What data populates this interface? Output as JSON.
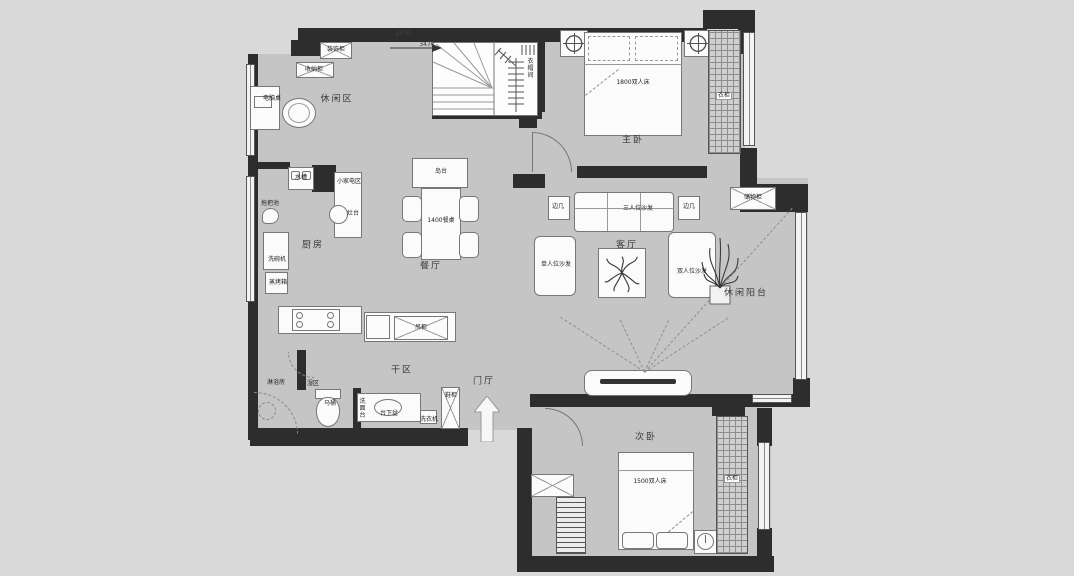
{
  "title": "apartment-floor-plan",
  "colors": {
    "background": "#d9d9d9",
    "floor": "#c5c5c5",
    "wall": "#2d2d2d",
    "furniture": "#fbfbfb",
    "line": "#777777"
  },
  "rooms": [
    "休闲区",
    "主卧",
    "客厅",
    "餐厅",
    "厨房",
    "干区",
    "湿区",
    "门厅",
    "休闲阳台",
    "次卧"
  ],
  "labels": [
    {
      "id": "leisure-area",
      "cls": "room",
      "text": "休闲区",
      "x": 337,
      "y": 100
    },
    {
      "id": "master-bedroom",
      "cls": "room",
      "text": "主卧",
      "x": 633,
      "y": 141
    },
    {
      "id": "living-room",
      "cls": "room",
      "text": "客厅",
      "x": 627,
      "y": 246
    },
    {
      "id": "dining-room",
      "cls": "room",
      "text": "餐厅",
      "x": 431,
      "y": 267
    },
    {
      "id": "kitchen",
      "cls": "room",
      "text": "厨房",
      "x": 313,
      "y": 246
    },
    {
      "id": "dry-area",
      "cls": "room",
      "text": "干区",
      "x": 402,
      "y": 371
    },
    {
      "id": "wet-area",
      "cls": "item",
      "text": "湿区",
      "x": 313,
      "y": 384
    },
    {
      "id": "shower-room",
      "cls": "item",
      "text": "淋浴房",
      "x": 276,
      "y": 383
    },
    {
      "id": "foyer",
      "cls": "room",
      "text": "门厅",
      "x": 484,
      "y": 382
    },
    {
      "id": "leisure-balcony",
      "cls": "room",
      "text": "休闲阳台",
      "x": 746,
      "y": 294
    },
    {
      "id": "second-bedroom",
      "cls": "room",
      "text": "次卧",
      "x": 646,
      "y": 438
    },
    {
      "id": "decor-cabinet",
      "cls": "item",
      "text": "装饰柜",
      "x": 336,
      "y": 50
    },
    {
      "id": "storage-low-cabinet",
      "cls": "item",
      "text": "收纳柜",
      "x": 314,
      "y": 70
    },
    {
      "id": "computer-desk",
      "cls": "item",
      "text": "电脑桌",
      "x": 272,
      "y": 99
    },
    {
      "id": "cloakroom",
      "cls": "vert",
      "text": "衣帽间",
      "x": 529,
      "y": 68
    },
    {
      "id": "master-bed",
      "cls": "item",
      "text": "1800双人床",
      "x": 633,
      "y": 83
    },
    {
      "id": "sofa-three-seat",
      "cls": "item",
      "text": "三人位沙发",
      "x": 638,
      "y": 209
    },
    {
      "id": "side-table-left",
      "cls": "item",
      "text": "边几",
      "x": 558,
      "y": 207
    },
    {
      "id": "side-table-right",
      "cls": "item",
      "text": "边几",
      "x": 689,
      "y": 207
    },
    {
      "id": "single-sofa",
      "cls": "item",
      "text": "单人位沙发",
      "x": 556,
      "y": 265
    },
    {
      "id": "double-sofa",
      "cls": "item",
      "text": "双人位沙发",
      "x": 692,
      "y": 272
    },
    {
      "id": "island-counter",
      "cls": "item",
      "text": "岛台",
      "x": 441,
      "y": 172
    },
    {
      "id": "dining-table",
      "cls": "item",
      "text": "1400餐桌",
      "x": 441,
      "y": 221
    },
    {
      "id": "stove",
      "cls": "item",
      "text": "灶台",
      "x": 353,
      "y": 214
    },
    {
      "id": "small-appliance-area",
      "cls": "item",
      "text": "小家电区",
      "x": 349,
      "y": 182
    },
    {
      "id": "sink",
      "cls": "item",
      "text": "水槽",
      "x": 301,
      "y": 178
    },
    {
      "id": "mop-basin",
      "cls": "item",
      "text": "拖把池",
      "x": 270,
      "y": 204
    },
    {
      "id": "dishwasher",
      "cls": "item",
      "text": "洗碗机",
      "x": 277,
      "y": 260
    },
    {
      "id": "steam-oven",
      "cls": "item",
      "text": "蒸烤箱",
      "x": 278,
      "y": 283
    },
    {
      "id": "hanging-cabinet",
      "cls": "item",
      "text": "吊柜",
      "x": 421,
      "y": 328
    },
    {
      "id": "toilet",
      "cls": "item",
      "text": "马桶",
      "x": 330,
      "y": 404
    },
    {
      "id": "vanity",
      "cls": "vert",
      "text": "洗面台",
      "x": 361,
      "y": 408
    },
    {
      "id": "under-counter-basin",
      "cls": "item",
      "text": "台下盆",
      "x": 389,
      "y": 414
    },
    {
      "id": "washing-machine",
      "cls": "item",
      "text": "洗衣机",
      "x": 429,
      "y": 420
    },
    {
      "id": "shoe-cabinet",
      "cls": "item",
      "text": "鞋柜",
      "x": 451,
      "y": 396
    },
    {
      "id": "balcony-storage",
      "cls": "item",
      "text": "储物柜",
      "x": 753,
      "y": 198
    },
    {
      "id": "master-wardrobe",
      "cls": "tag",
      "text": "衣柜",
      "x": 724,
      "y": 96
    },
    {
      "id": "bedroom2-wardrobe",
      "cls": "tag",
      "text": "衣柜",
      "x": 732,
      "y": 479
    },
    {
      "id": "bed2",
      "cls": "item",
      "text": "1500双人床",
      "x": 650,
      "y": 482
    },
    {
      "id": "dim-upper",
      "cls": "dim",
      "text": "2270",
      "x": 403,
      "y": 34
    },
    {
      "id": "dim-lower",
      "cls": "dim",
      "text": "3470",
      "x": 427,
      "y": 45
    }
  ]
}
